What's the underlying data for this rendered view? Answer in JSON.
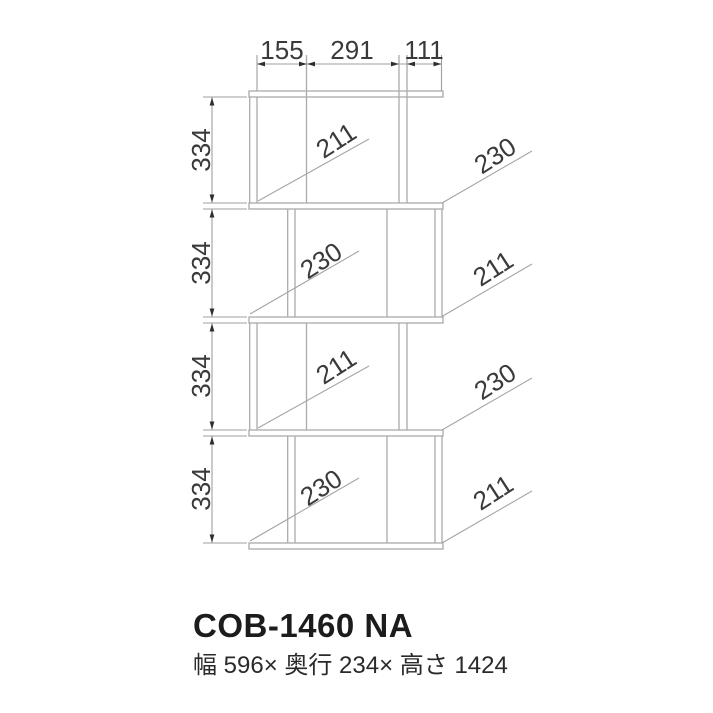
{
  "drawing_title": "furniture front-view dimension drawing",
  "dims": {
    "top": [
      "155",
      "291",
      "111"
    ],
    "left": [
      "334",
      "334",
      "334",
      "334"
    ],
    "inner": [
      "211",
      "230",
      "211",
      "230"
    ],
    "right": [
      "230",
      "211",
      "230",
      "211"
    ]
  },
  "footer": {
    "model": "COB-1460 NA",
    "size_text": "幅 596× 奥行 234× 高さ 1424"
  },
  "colors": {
    "structure_line": "#ababab",
    "dimension_line": "#9f9f9f",
    "arrow": "#2e2e2e",
    "dimension_text": "#3a3a3a",
    "title_text": "#1c1c1c",
    "background": "#ffffff"
  }
}
